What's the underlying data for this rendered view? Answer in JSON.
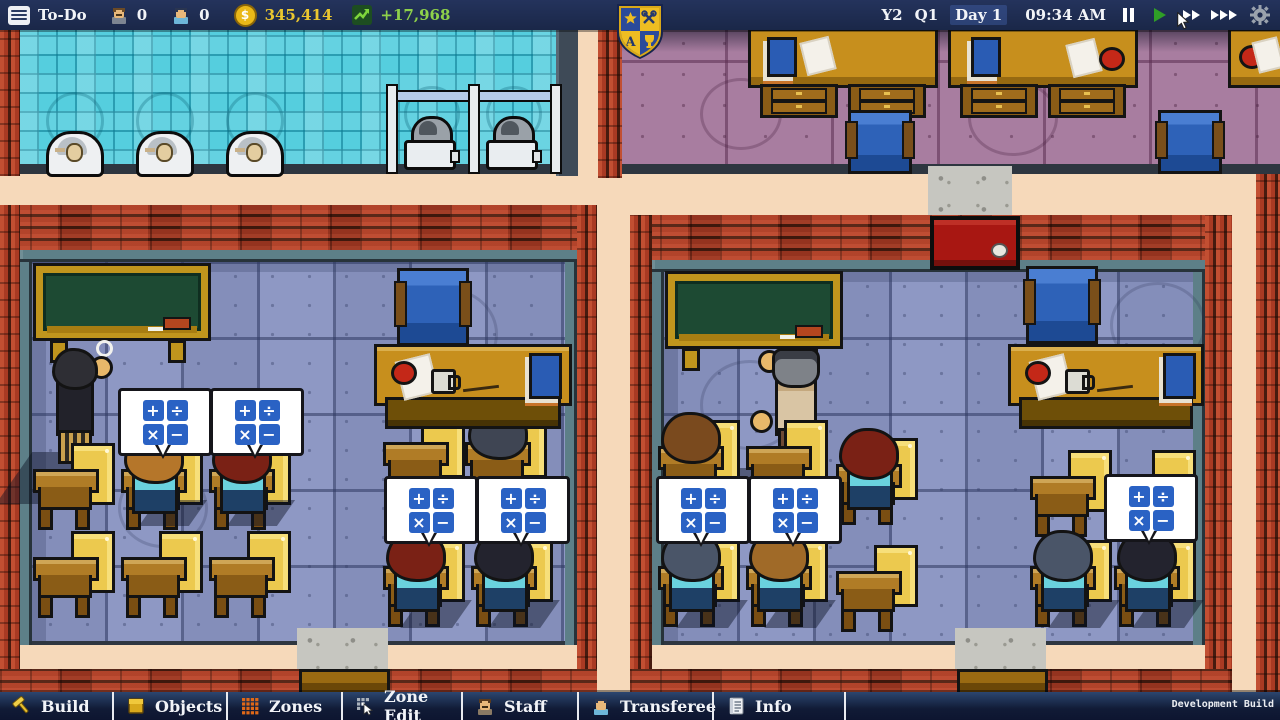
{
  "top_bar": {
    "todo_label": "To-Do",
    "staff_count": "0",
    "students_count": "0",
    "currency_symbol": "$",
    "money": "345,414",
    "money_delta": "+17,968",
    "year": "Y2",
    "quarter": "Q1",
    "day": "Day 1",
    "time": "09:34 AM",
    "speed_controls": [
      "pause",
      "play",
      "fast-forward",
      "fastest-forward"
    ],
    "colors": {
      "bar_bg": "#1c2a50",
      "money": "#eac62f",
      "delta": "#8ed14a"
    }
  },
  "logo": {
    "name": "school-crest",
    "colors": {
      "navy": "#24386e",
      "gold": "#eebd22"
    }
  },
  "bottom_bar": {
    "tabs": [
      {
        "label": "Build",
        "icon": "hammer-icon"
      },
      {
        "label": "Objects",
        "icon": "furniture-icon"
      },
      {
        "label": "Zones",
        "icon": "zones-grid-icon"
      },
      {
        "label": "Zone Edit",
        "icon": "zone-edit-icon"
      },
      {
        "label": "Staff",
        "icon": "staff-person-icon"
      },
      {
        "label": "Transferee",
        "icon": "transferee-person-icon"
      },
      {
        "label": "Info",
        "icon": "info-document-icon"
      }
    ],
    "version_label": "Development Build"
  },
  "scene": {
    "thought_bubble_symbols": [
      "+",
      "÷",
      "×",
      "−"
    ],
    "rooms": [
      "bathroom",
      "upper-classroom",
      "left-classroom",
      "right-classroom"
    ],
    "colors": {
      "corridor": "#f6d9ba",
      "brick": "#a93a23",
      "bathroom_tile": "#55cede",
      "classroom_floor": "#8e98c4",
      "upper_floor": "#a87da0",
      "chalkboard": "#1d4a33",
      "desk_wood": "#c78f1d",
      "chair_blue": "#2e62b8",
      "door_red": "#a81712",
      "door_wood": "#9a6a12",
      "bubble_tile": "#2a62c4"
    }
  }
}
